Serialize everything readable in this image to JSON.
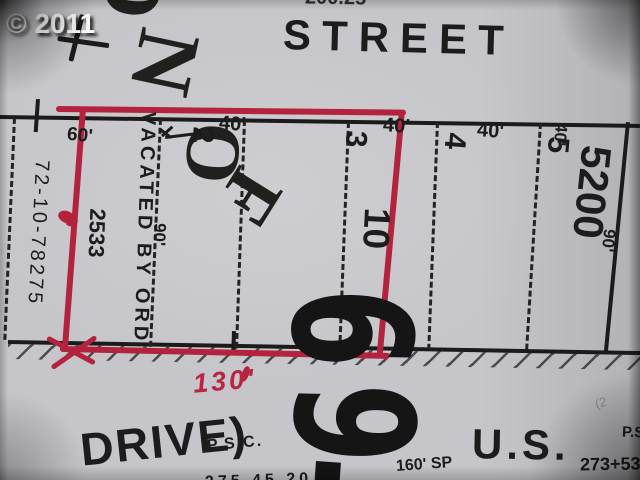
{
  "photo": {
    "credit": "© 2011"
  },
  "map": {
    "street_label": "STREET",
    "top_partial_number": "200.25",
    "watermark": {
      "top_letters": [
        "O",
        "N"
      ],
      "mid_letters": [
        "O",
        "F"
      ]
    },
    "lots": [
      {
        "number": "2",
        "width": "40'"
      },
      {
        "number": "3",
        "width": "40'"
      },
      {
        "number": "4",
        "width": "40'"
      },
      {
        "number": "5",
        "width": "40'"
      }
    ],
    "inner_lot_number": "10",
    "block_number": "5200",
    "depth_label_left": "90'",
    "depth_label_right": "90'",
    "front_label": "60'",
    "vacated_note": {
      "line1": "VACATED BY ORD",
      "line2": "2533"
    },
    "survey_ref": "72-10-78275",
    "big_number": {
      "digits": [
        "6",
        "9"
      ]
    },
    "red_markup": {
      "frontage": "130'"
    },
    "bottom": {
      "drive": "DRIVE)",
      "psc": "P.S.C.",
      "us": "U.S.",
      "ps_right": "P.S",
      "station": "273+53",
      "sp": "160' SP",
      "partial_numbers": "275 45.20",
      "faint_mark": "(2"
    }
  },
  "colors": {
    "paper": "#c6c5c9",
    "ink": "#1b1b1b",
    "red_marker": "#b3233e",
    "credit_text": "#ffffff"
  }
}
